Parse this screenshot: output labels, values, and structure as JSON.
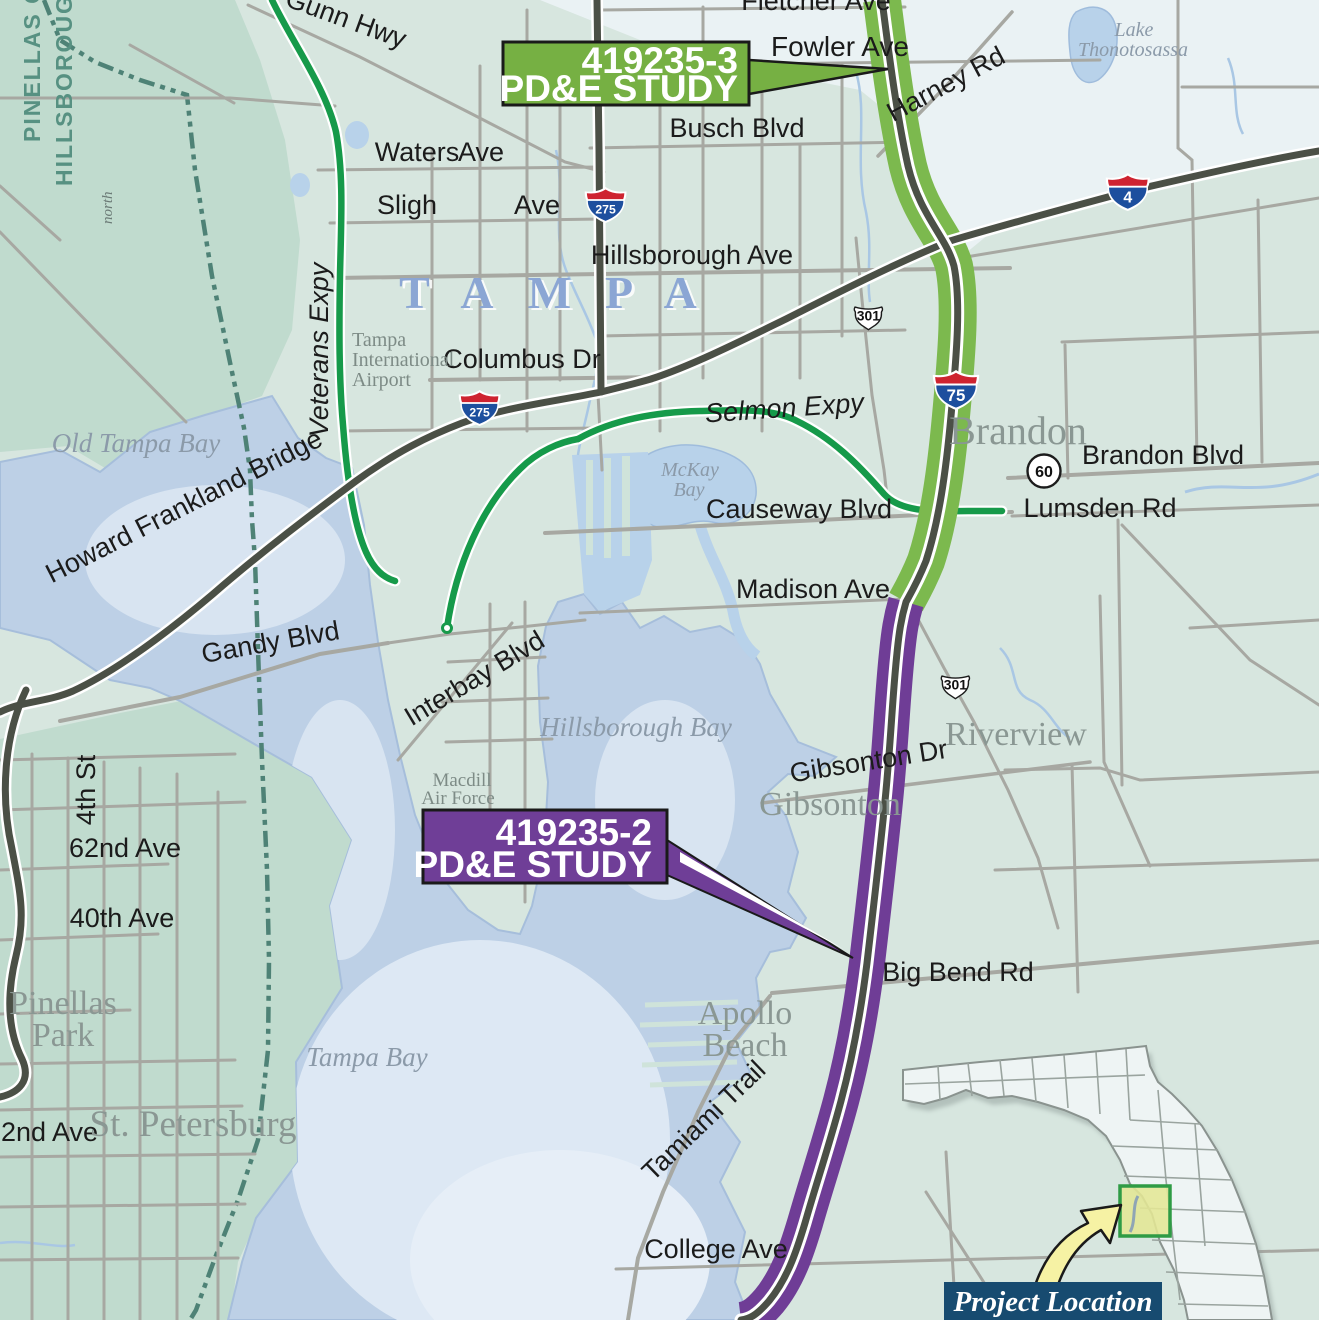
{
  "callouts": {
    "north": {
      "project": "419235-3",
      "study": "PD&E STUDY",
      "color": "#76b043"
    },
    "south": {
      "project": "419235-2",
      "study": "PD&E STUDY",
      "color": "#6f3e97"
    }
  },
  "inset": {
    "label": "Project Location",
    "highlight_border": "#2f9b45",
    "box_bg": "#174b70"
  },
  "counties": {
    "pinellas": "PINELLAS COUNTY",
    "hillsborough": "HILLSBOROUGH COUNTY"
  },
  "shields": {
    "i275_a": "275",
    "i275_b": "275",
    "i75": "75",
    "i4": "4",
    "us301_a": "301",
    "us301_b": "301",
    "sr60": "60"
  },
  "places": {
    "tampa": "TAMPA",
    "brandon": "Brandon",
    "riverview": "Riverview",
    "gibsonton": "Gibsonton",
    "apollo1": "Apollo",
    "apollo2": "Beach",
    "pinellas1": "Pinellas",
    "pinellas2": "Park",
    "stpete": "St. Petersburg"
  },
  "water": {
    "old_tampa": "Old Tampa Bay",
    "tampa_bay": "Tampa Bay",
    "hillsborough_bay": "Hillsborough Bay",
    "mckay1": "McKay",
    "mckay2": "Bay",
    "lake1": "Lake",
    "lake2": "Thonotosassa"
  },
  "landmarks": {
    "airport1": "Tampa",
    "airport2": "International",
    "airport3": "Airport",
    "macdill1": "Macdill",
    "macdill2": "Air Force",
    "north": "north"
  },
  "roads": {
    "fletcher": "Fletcher Ave",
    "fowler": "Fowler Ave",
    "harney": "Harney Rd",
    "busch": "Busch Blvd",
    "waters": "Waters",
    "waters_ave": "Ave",
    "sligh": "Sligh",
    "sligh_ave": "Ave",
    "hillsborough": "Hillsborough Ave",
    "columbus": "Columbus Dr",
    "gunn": "Gunn Hwy",
    "veterans": "Veterans Expy",
    "selmon": "Selmon  Expy",
    "howard_frankland": "Howard Frankland Bridge",
    "gandy": "Gandy Blvd",
    "interbay": "Interbay Blvd",
    "causeway": "Causeway Blvd",
    "madison": "Madison Ave",
    "brandon_blvd": "Brandon Blvd",
    "lumsden": "Lumsden Rd",
    "gibsonton_dr": "Gibsonton  Dr",
    "big_bend": "Big  Bend Rd",
    "college": "College Ave",
    "tamiami": "Tamiami Trail",
    "st4": "4th St",
    "ave62": "62nd Ave",
    "ave40": "40th Ave",
    "ave22": "22nd Ave"
  },
  "colors": {
    "corridor_north": "#7cb94e",
    "corridor_south": "#6f3d96",
    "expressway": "#169a4a",
    "major_road": "#4b5046",
    "minor_road": "#a7a8a2",
    "water": "#bdd0e6",
    "county_line": "#4e8276"
  }
}
